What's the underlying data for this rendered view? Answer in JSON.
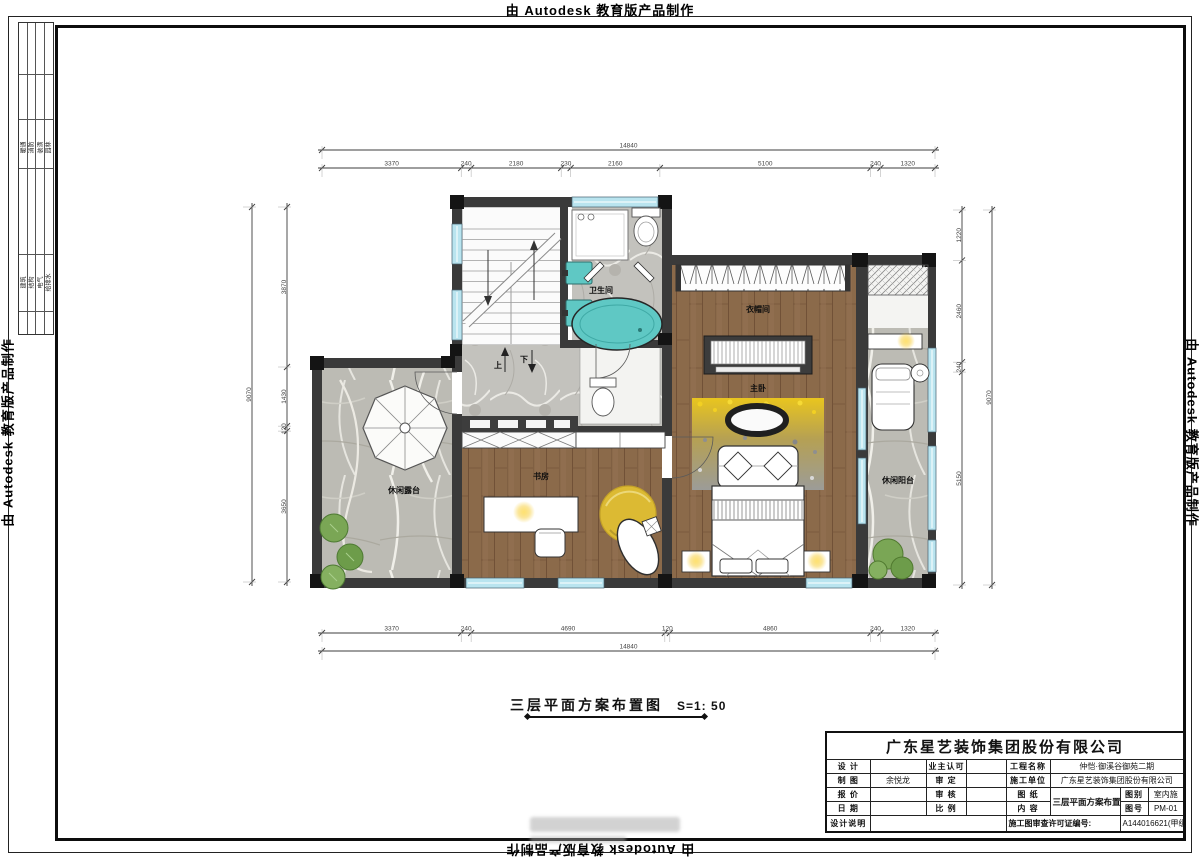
{
  "border": {
    "autodesk": "由 Autodesk 教育版产品制作"
  },
  "signoff": {
    "upper": [
      "暖通",
      "消防",
      "装潢",
      "园林"
    ],
    "lower": [
      "建筑",
      "结构",
      "电气",
      "给排水"
    ]
  },
  "plan": {
    "title": "三层平面方案布置图",
    "scale": "S=1: 50",
    "labels": [
      {
        "id": "bathroom",
        "text": "卫生间",
        "x": 601,
        "y": 293
      },
      {
        "id": "cloakroom",
        "text": "衣帽间",
        "x": 758,
        "y": 312
      },
      {
        "id": "master-bedroom",
        "text": "主卧",
        "x": 758,
        "y": 391
      },
      {
        "id": "study",
        "text": "书房",
        "x": 541,
        "y": 479
      },
      {
        "id": "terrace",
        "text": "休闲露台",
        "x": 404,
        "y": 493
      },
      {
        "id": "balcony",
        "text": "休闲阳台",
        "x": 898,
        "y": 483
      },
      {
        "id": "stair-up",
        "text": "上",
        "x": 498,
        "y": 368
      },
      {
        "id": "stair-down",
        "text": "下",
        "x": 524,
        "y": 362
      }
    ],
    "dimensions": {
      "top": {
        "overall": "14840",
        "segments": [
          "3370",
          "240",
          "2180",
          "230",
          "2160",
          "5100",
          "240",
          "1320"
        ]
      },
      "bottom": {
        "overall": "14840",
        "segments": [
          "3370",
          "240",
          "4690",
          "120",
          "4860",
          "240",
          "1320"
        ]
      },
      "left": {
        "overall": "9070",
        "segments": [
          "3870",
          "1430",
          "120",
          "3650"
        ]
      },
      "right": {
        "overall": "9070",
        "segments": [
          "1220",
          "2460",
          "240",
          "5150"
        ]
      }
    }
  },
  "titleblock": {
    "company": "广东星艺装饰集团股份有限公司",
    "rows": [
      {
        "c1": "设 计",
        "v1": "",
        "c2": "业主认可",
        "v2": "",
        "c3": "工程名称",
        "v3": "仲恺·御溪谷御苑二期"
      },
      {
        "c1": "制 图",
        "v1": "余悦龙",
        "c2": "审 定",
        "v2": "",
        "c3": "施工单位",
        "v3": "广东星艺装饰集团股份有限公司"
      },
      {
        "c1": "报 价",
        "v1": "",
        "c2": "审 核",
        "v2": "",
        "c3": "图 纸",
        "v3": "三层平面方案布置图",
        "c4": "图别",
        "v4": "室内施"
      },
      {
        "c1": "日 期",
        "v1": "",
        "c2": "比 例",
        "v2": "",
        "c3": "内 容",
        "v3": "",
        "c4": "图号",
        "v4": "PM-01"
      }
    ],
    "footer": {
      "label": "设计说明",
      "permit_label": "施工图审查许可证编号:",
      "permit_value": "A144016621(甲级)"
    }
  },
  "colors": {
    "wall": "#3a3a3a",
    "column": "#141414",
    "wood": "#8b6a4a",
    "marble": "#c3c2bd",
    "fixture_teal": "#5fc8c4",
    "window_glass": "#b9e4ef",
    "rug_yellow": "#dcba33",
    "glow_yellow": "#ffd94f",
    "plant_green": "#7aa655"
  }
}
